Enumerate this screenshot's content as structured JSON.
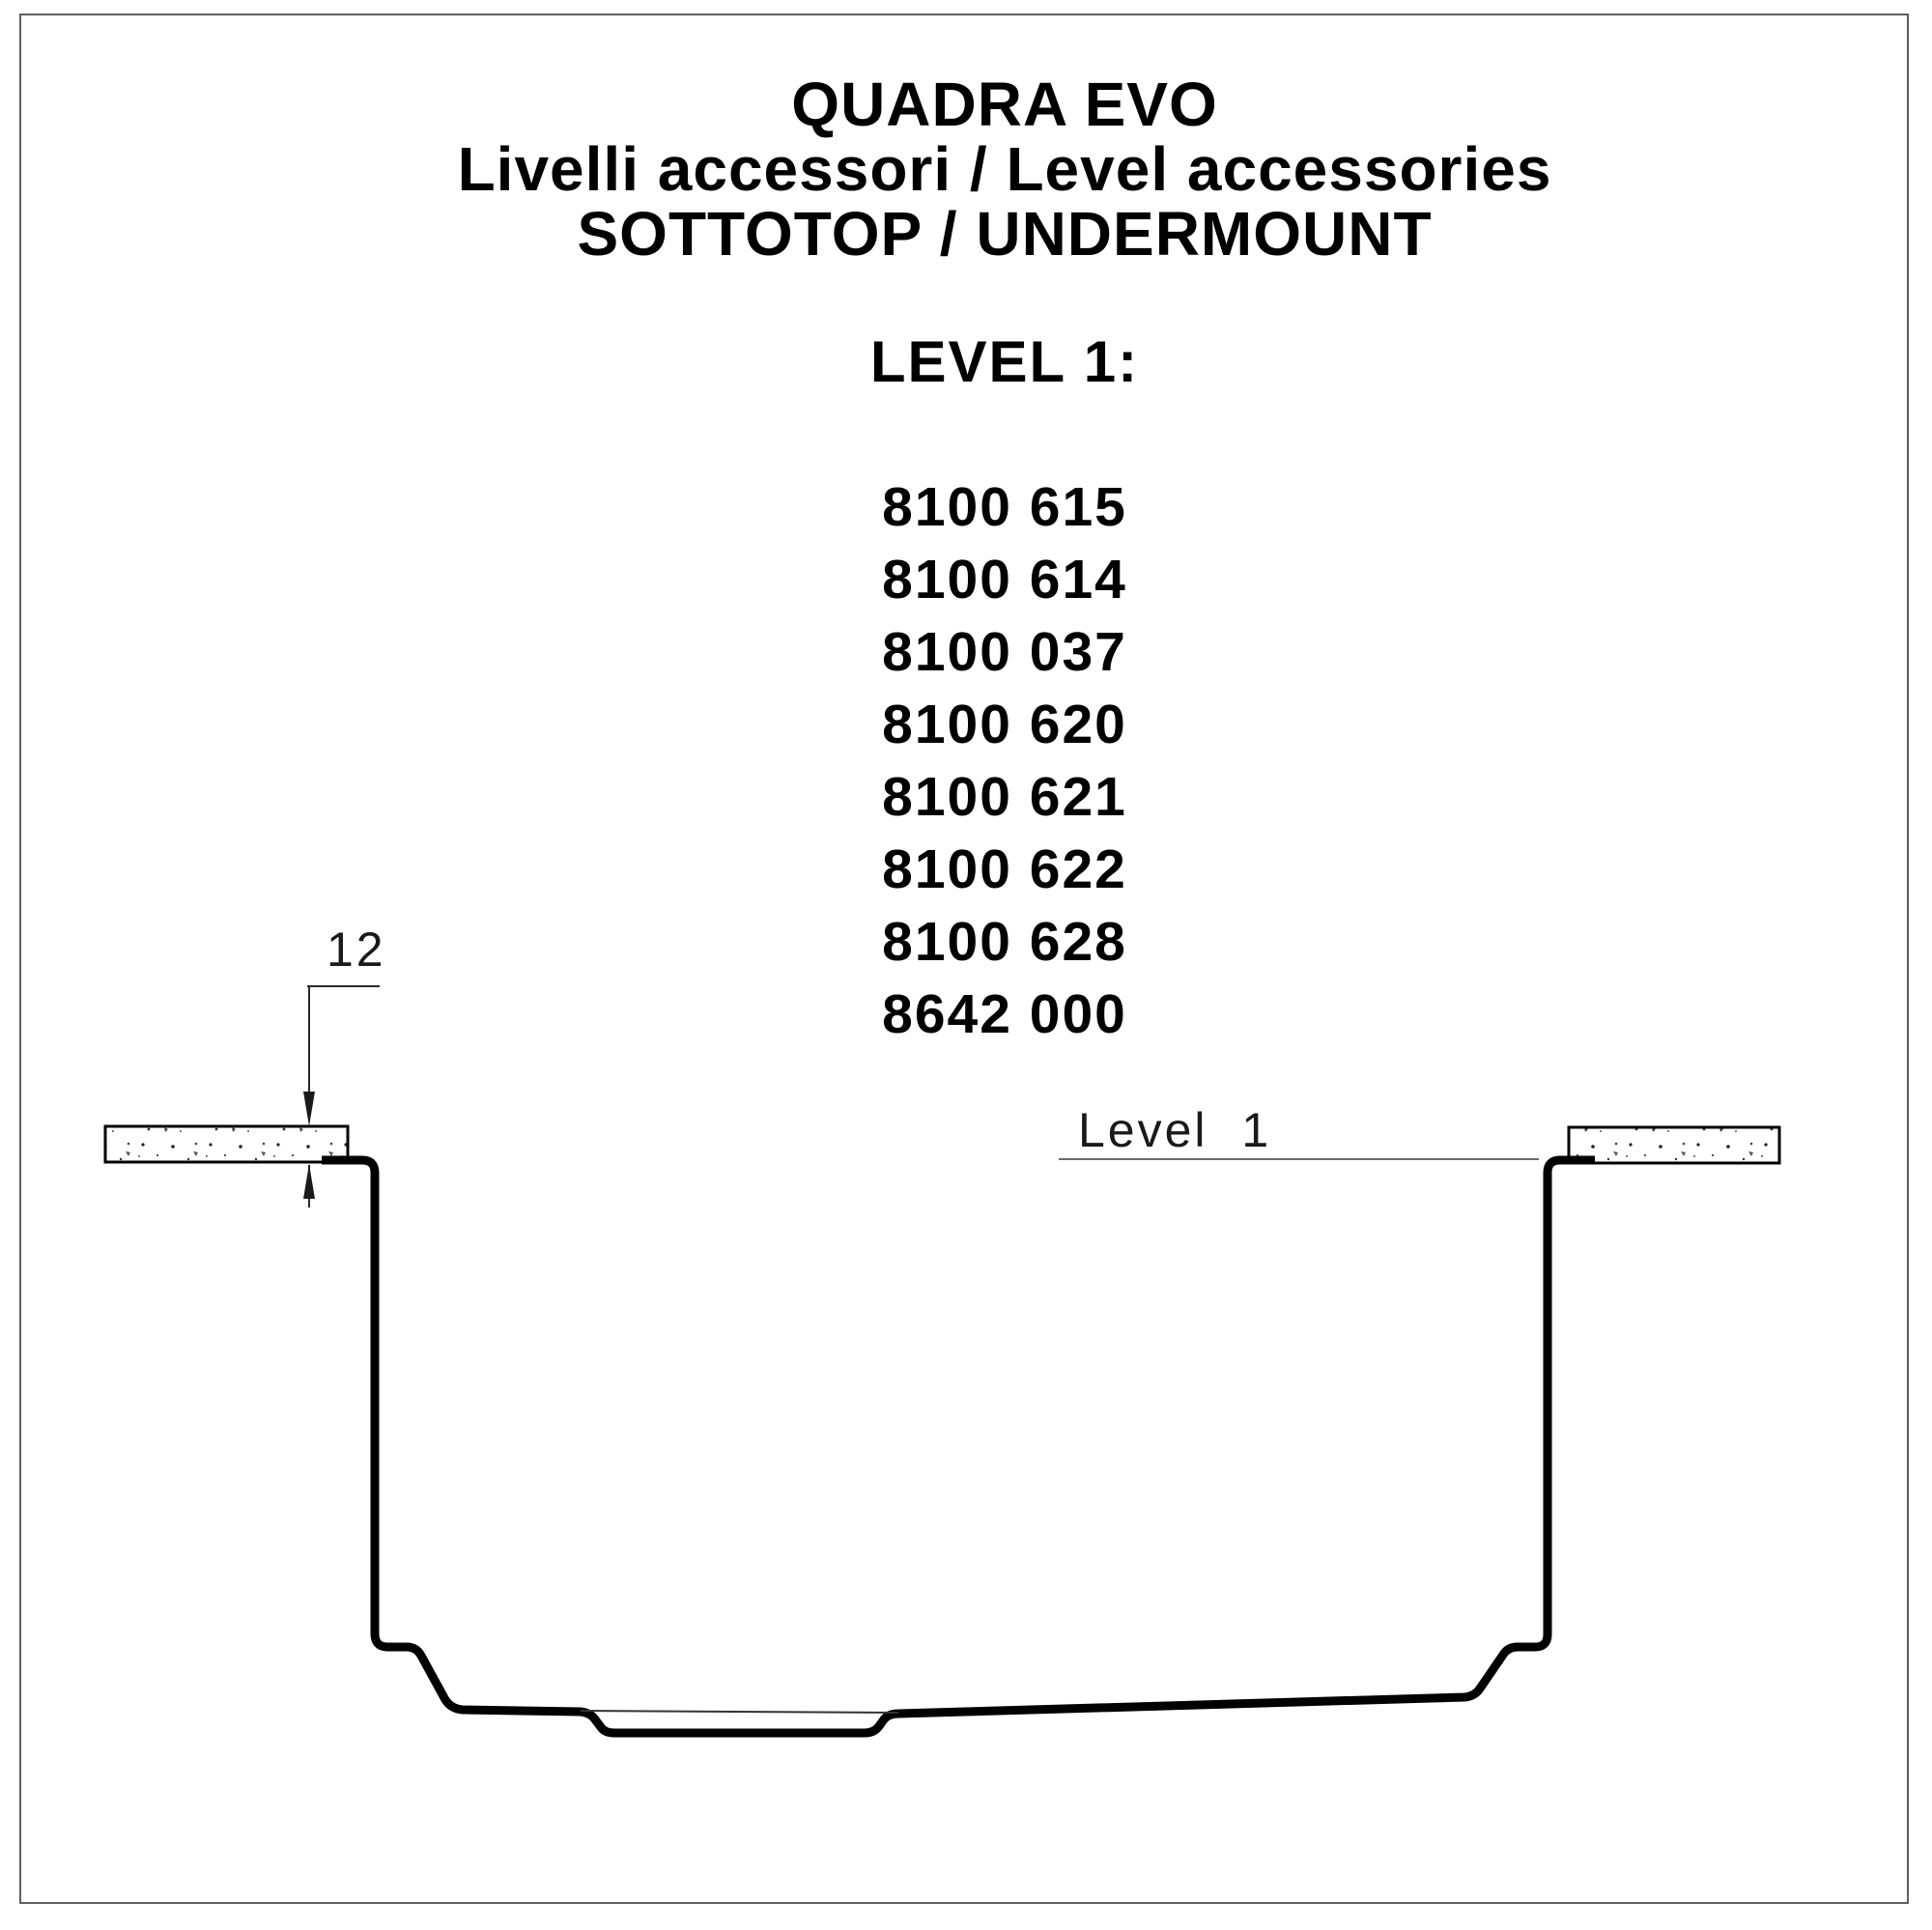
{
  "header": {
    "title": "QUADRA EVO",
    "subtitle": "Livelli accessori / Level accessories",
    "mounting": "SOTTOTOP / UNDERMOUNT",
    "section_heading": "LEVEL 1:"
  },
  "product_codes": [
    "8100 615",
    "8100 614",
    "8100 037",
    "8100 620",
    "8100 621",
    "8100 622",
    "8100 628",
    "8642 000"
  ],
  "diagram": {
    "dimension_label": "12",
    "level_label": "Level 1"
  },
  "colors": {
    "ink": "#000000",
    "frame_border": "#5f5f5f",
    "level_line": "#6b6b6b",
    "dimension_line": "#2a2a2a"
  }
}
